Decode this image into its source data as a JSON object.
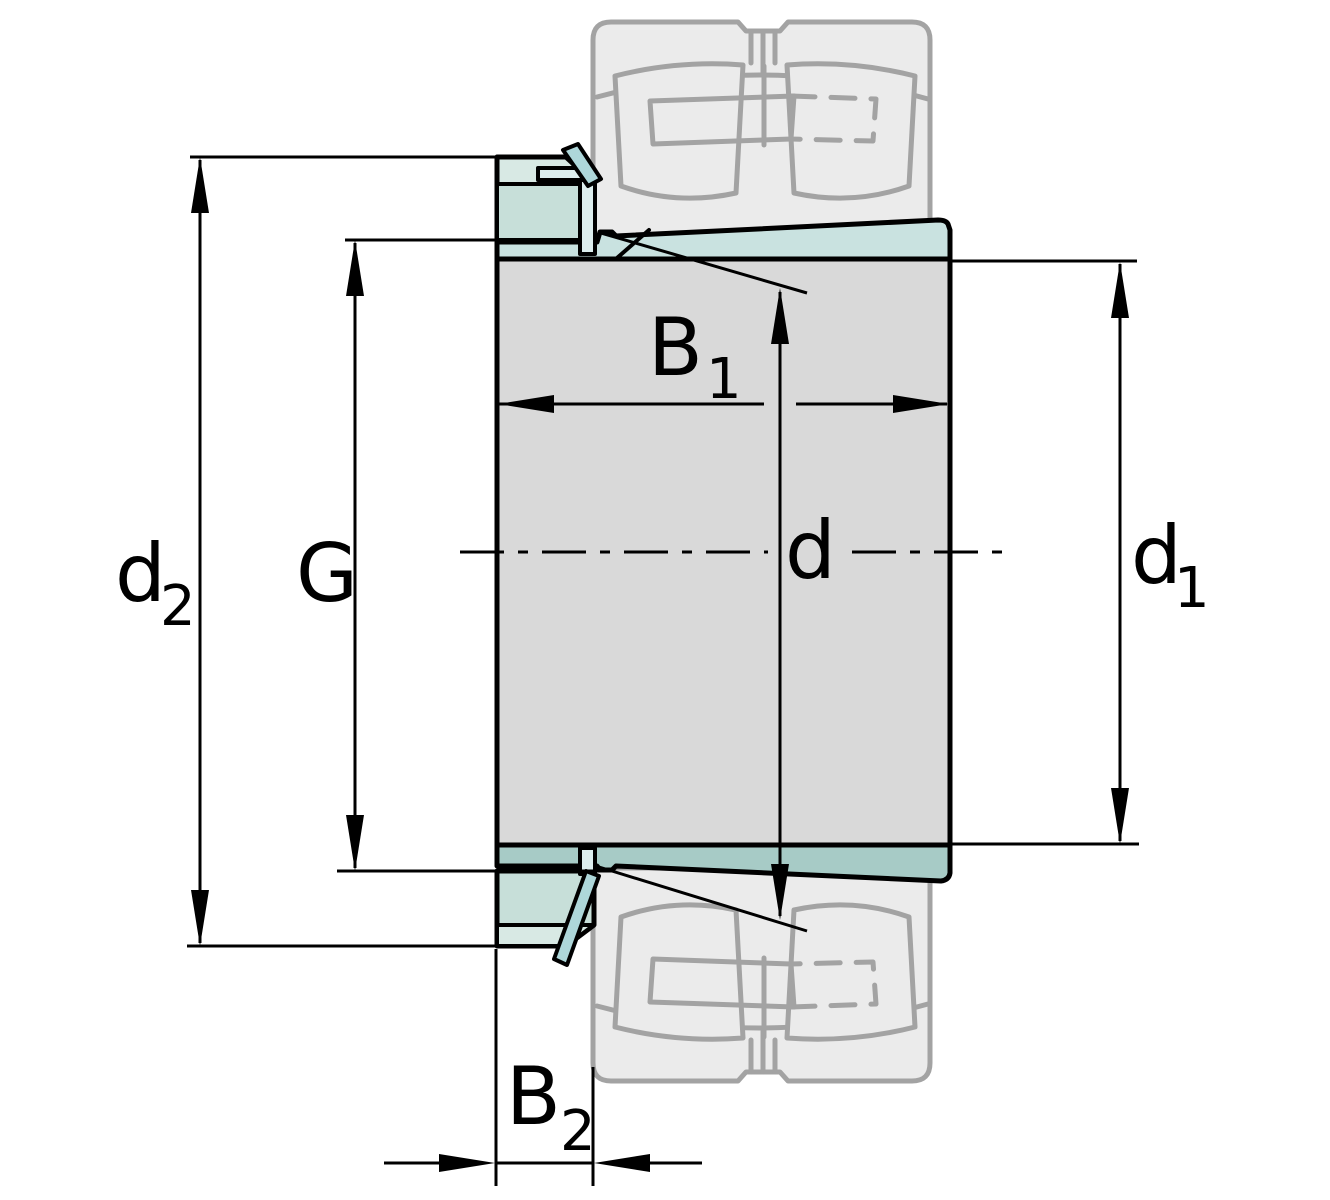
{
  "labels": {
    "d2": {
      "base": "d",
      "sub": "2"
    },
    "g": {
      "base": "G",
      "sub": ""
    },
    "b1": {
      "base": "B",
      "sub": "1"
    },
    "d": {
      "base": "d",
      "sub": ""
    },
    "d1": {
      "base": "d",
      "sub": "1"
    },
    "b2": {
      "base": "B",
      "sub": "2"
    }
  },
  "colors": {
    "outline": "#000000",
    "ghost_line": "#a3a3a3",
    "ghost_fill": "#ebebeb",
    "body_fill": "#d9d9d9",
    "taper_top_fill": "#c9e2e0",
    "taper_bottom_fill": "#a7cbc6",
    "nut_fill": "#d8e9e4",
    "nut_band_fill": "#c7dfd9",
    "washer_fill": "#ddeeee",
    "washer_tab_fill": "#aed7da",
    "background": "#ffffff"
  }
}
